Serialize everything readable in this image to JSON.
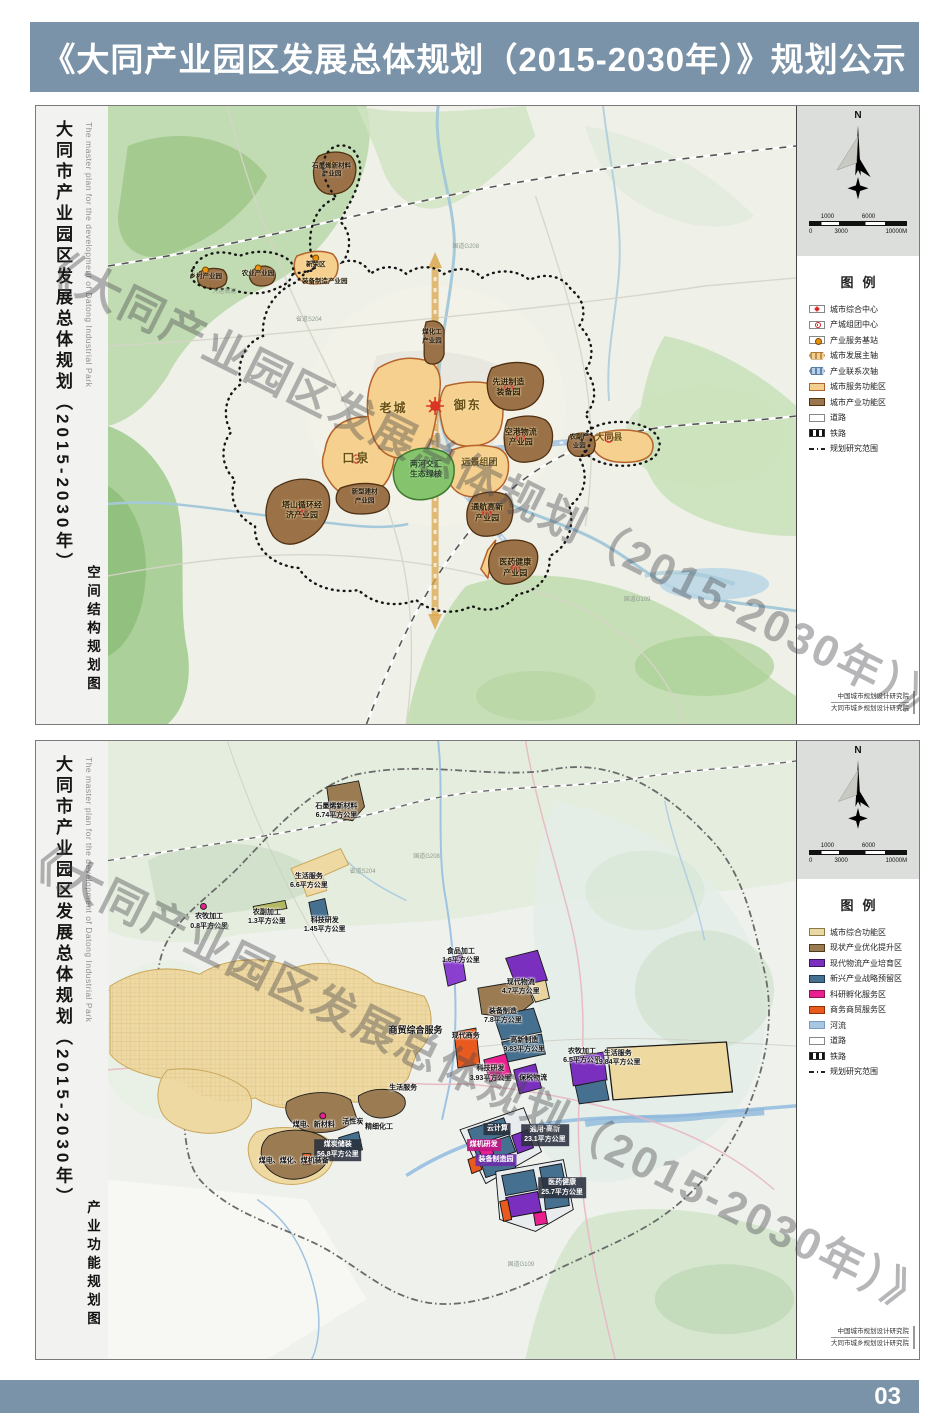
{
  "page": {
    "header_title": "《大同产业园区发展总体规划（2015-2030年）》规划公示",
    "page_number": "03"
  },
  "shared": {
    "sidebar_title_cn": "大同市产业园区发展总体规划（2015-2030年）",
    "sidebar_title_en": "The master plan for the development of Datong Industrial Park",
    "compass_n": "N",
    "watermark": "《大同产业园区发展总体规划（2015-2030年）》公示稿",
    "scale_top": [
      {
        "t": "1000",
        "x": 12
      },
      {
        "t": "6000",
        "x": 54
      }
    ],
    "scale_bottom": [
      {
        "t": "0",
        "x": 0
      },
      {
        "t": "3000",
        "x": 26
      },
      {
        "t": "10000M",
        "x": 78
      }
    ],
    "credits": [
      {
        "t": "中国城市规划设计研究院"
      },
      {
        "t": "大同市城乡规划设计研究院"
      }
    ]
  },
  "panel1": {
    "map_type_label": "空间结构规划图",
    "legend_title": "图例",
    "legend": [
      {
        "label": "城市综合中心",
        "sw": "sym-star"
      },
      {
        "label": "产城组团中心",
        "sw": "sym-ring"
      },
      {
        "label": "产业服务基站",
        "sw": "sym-dot"
      },
      {
        "label": "城市发展主轴",
        "sw": "axis-major"
      },
      {
        "label": "产业联系次轴",
        "sw": "axis-minor"
      },
      {
        "label": "城市服务功能区",
        "sw": "fill-tan"
      },
      {
        "label": "城市产业功能区",
        "sw": "fill-brown"
      },
      {
        "label": "道路",
        "sw": "road"
      },
      {
        "label": "铁路",
        "sw": "rail"
      },
      {
        "label": "规划研究范围",
        "sw": "bound"
      }
    ],
    "labels": [
      {
        "text": "老城",
        "x": 41.5,
        "y": 49,
        "cls": "l-big"
      },
      {
        "text": "御东",
        "x": 52.3,
        "y": 48.5,
        "cls": "l-big"
      },
      {
        "text": "口泉",
        "x": 36.1,
        "y": 57.1,
        "cls": "l-big"
      },
      {
        "text": "远景组团",
        "x": 54,
        "y": 57.8,
        "cls": "l-mid"
      },
      {
        "text": "两河交汇\n生态绿核",
        "x": 46.2,
        "y": 58.9,
        "cls": "l-green"
      },
      {
        "text": "先进制造\n装备园",
        "x": 58.2,
        "y": 45.6,
        "cls": "l-dark"
      },
      {
        "text": "空港物流\n产业园",
        "x": 60,
        "y": 53.7,
        "cls": "l-dark"
      },
      {
        "text": "通航高新\n产业园",
        "x": 55.1,
        "y": 65.9,
        "cls": "l-dark"
      },
      {
        "text": "医药健康\n产业园",
        "x": 59.2,
        "y": 74.8,
        "cls": "l-dark"
      },
      {
        "text": "塔山循环经\n济产业园",
        "x": 28.2,
        "y": 65.5,
        "cls": "l-dark"
      },
      {
        "text": "新型建材\n产业园",
        "x": 37.3,
        "y": 63.3,
        "cls": "l-tiny"
      },
      {
        "text": "大同县",
        "x": 72.8,
        "y": 53.7,
        "cls": "l-mid"
      },
      {
        "text": "农副产\n业园",
        "x": 68.5,
        "y": 54.4,
        "cls": "l-tiny"
      },
      {
        "text": "石墨烯新材料\n产业园",
        "x": 32.5,
        "y": 10.5,
        "cls": "l-tiny"
      },
      {
        "text": "新荣区",
        "x": 30.2,
        "y": 25.7,
        "cls": "l-tiny"
      },
      {
        "text": "装备制造产业园",
        "x": 31.5,
        "y": 28.4,
        "cls": "l-tiny"
      },
      {
        "text": "煤化工\n产业园",
        "x": 47.1,
        "y": 37.4,
        "cls": "l-tiny"
      },
      {
        "text": "乡村产业园",
        "x": 14.2,
        "y": 27.7,
        "cls": "l-tiny"
      },
      {
        "text": "农业产业园",
        "x": 21.8,
        "y": 27.2,
        "cls": "l-tiny"
      },
      {
        "text": "大运高速",
        "x": 16.9,
        "y": 30.3,
        "cls": "l-road"
      },
      {
        "text": "国道G208",
        "x": 52,
        "y": 23,
        "cls": "l-road"
      },
      {
        "text": "省道S204",
        "x": 29.2,
        "y": 34.8,
        "cls": "l-road"
      },
      {
        "text": "国道G109",
        "x": 76.9,
        "y": 80.1,
        "cls": "l-road"
      }
    ]
  },
  "panel2": {
    "map_type_label": "产业功能规划图",
    "legend_title": "图例",
    "legend": [
      {
        "label": "城市综合功能区",
        "sw": "fill-tan2"
      },
      {
        "label": "现状产业优化提升区",
        "sw": "fill-brown2"
      },
      {
        "label": "现代物流产业培育区",
        "sw": "fill-purple"
      },
      {
        "label": "新兴产业战略预留区",
        "sw": "fill-blue"
      },
      {
        "label": "科研孵化服务区",
        "sw": "fill-magenta"
      },
      {
        "label": "商务商贸服务区",
        "sw": "fill-orange"
      },
      {
        "label": "河流",
        "sw": "fill-river"
      },
      {
        "label": "道路",
        "sw": "road"
      },
      {
        "label": "铁路",
        "sw": "rail"
      },
      {
        "label": "规划研究范围",
        "sw": "bound"
      }
    ],
    "labels": [
      {
        "text": "石墨烯新材料\n6.74平方公里",
        "x": 33.2,
        "y": 11.3,
        "cls": "l-d2"
      },
      {
        "text": "生活服务\n6.6平方公里",
        "x": 29.2,
        "y": 22.6,
        "cls": "l-d2"
      },
      {
        "text": "农牧加工\n0.8平方公里",
        "x": 14.7,
        "y": 29.2,
        "cls": "l-d2"
      },
      {
        "text": "农副加工\n1.3平方公里",
        "x": 23.1,
        "y": 28.5,
        "cls": "l-d2"
      },
      {
        "text": "科技研发\n1.45平方公里",
        "x": 31.5,
        "y": 29.8,
        "cls": "l-d2"
      },
      {
        "text": "食品加工\n1.6平方公里",
        "x": 51.3,
        "y": 34.8,
        "cls": "l-d2"
      },
      {
        "text": "现代物流\n4.7平方公里",
        "x": 60,
        "y": 39.8,
        "cls": "l-d2"
      },
      {
        "text": "装备制造\n7.8平方公里",
        "x": 57.4,
        "y": 44.5,
        "cls": "l-d2"
      },
      {
        "text": "商贸综合服务",
        "x": 44.7,
        "y": 46.9,
        "cls": "l-d2b"
      },
      {
        "text": "现代商务",
        "x": 52,
        "y": 47.7,
        "cls": "l-d2"
      },
      {
        "text": "高新制造\n9.83平方公里",
        "x": 60.5,
        "y": 49.2,
        "cls": "l-d2"
      },
      {
        "text": "科技研发\n3.93平方公里",
        "x": 55.6,
        "y": 53.8,
        "cls": "l-d2"
      },
      {
        "text": "保税物流",
        "x": 61.8,
        "y": 54.6,
        "cls": "l-d2"
      },
      {
        "text": "农牧加工\n6.5平方公里",
        "x": 68.9,
        "y": 51,
        "cls": "l-d2"
      },
      {
        "text": "生活服务\n19.84平方公里",
        "x": 74.1,
        "y": 51.3,
        "cls": "l-d2"
      },
      {
        "text": "生活服务",
        "x": 42.9,
        "y": 56.1,
        "cls": "l-d2"
      },
      {
        "text": "云计算",
        "x": 56.6,
        "y": 62.8,
        "cls": "l-badge"
      },
      {
        "text": "煤机研发",
        "x": 54.6,
        "y": 65.4,
        "cls": "l-badge-m"
      },
      {
        "text": "装备制造园",
        "x": 56.4,
        "y": 67.8,
        "cls": "l-badge-p"
      },
      {
        "text": "通用·高新\n23.1平方公里",
        "x": 63.5,
        "y": 63.8,
        "cls": "l-badge"
      },
      {
        "text": "医药健康\n25.7平方公里",
        "x": 66,
        "y": 72.3,
        "cls": "l-badge"
      },
      {
        "text": "煤电、新材料",
        "x": 29.9,
        "y": 62.2,
        "cls": "l-d2"
      },
      {
        "text": "活性炭",
        "x": 35.6,
        "y": 61.7,
        "cls": "l-d2"
      },
      {
        "text": "精细化工",
        "x": 39.4,
        "y": 62.4,
        "cls": "l-d2"
      },
      {
        "text": "煤炭储装\n56.8平方公里",
        "x": 33.4,
        "y": 66.2,
        "cls": "l-badge"
      },
      {
        "text": "煤电、煤化、煤机装备",
        "x": 27,
        "y": 68,
        "cls": "l-d2"
      },
      {
        "text": "大运高速",
        "x": 15.9,
        "y": 30.5,
        "cls": "l-road"
      },
      {
        "text": "国道G208",
        "x": 46.3,
        "y": 18.9,
        "cls": "l-road"
      },
      {
        "text": "省道S204",
        "x": 37,
        "y": 21.3,
        "cls": "l-road"
      },
      {
        "text": "国道G109",
        "x": 60,
        "y": 85,
        "cls": "l-road"
      }
    ]
  }
}
